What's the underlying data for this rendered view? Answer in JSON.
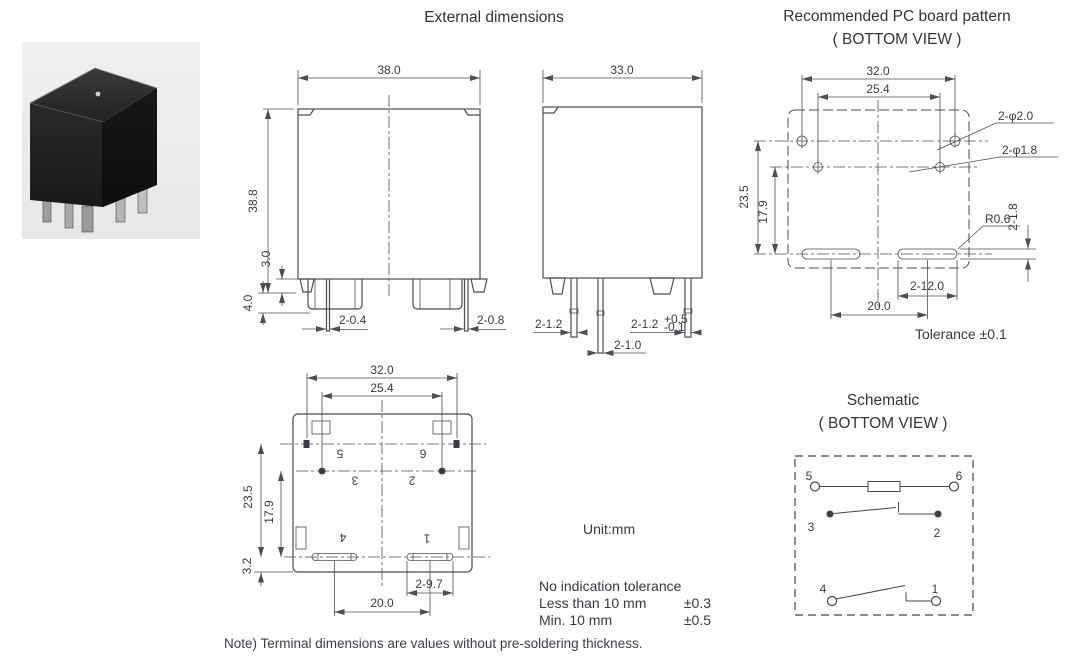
{
  "titles": {
    "external": "External dimensions",
    "pcb1": "Recommended PC board pattern",
    "pcb2": "( BOTTOM VIEW )",
    "sch1": "Schematic",
    "sch2": "( BOTTOM VIEW )"
  },
  "front_view": {
    "width": "38.0",
    "height": "38.8",
    "standoff": "3.0",
    "terminal": "4.0",
    "pin_thin": "2-0.4",
    "pin_wide": "2-0.8"
  },
  "side_view": {
    "width": "33.0",
    "pin_left": "2-1.2",
    "pin_right": "2-1.2",
    "pin_right_sup": "+0.5",
    "pin_right_sub": "-0.1",
    "pin_center": "2-1.0"
  },
  "bottom_view": {
    "w_outer": "32.0",
    "w_inner": "25.4",
    "h_outer": "23.5",
    "h_inner": "17.9",
    "offset": "3.2",
    "slot": "2-9.7",
    "pitch": "20.0",
    "pin5": "5",
    "pin6": "6",
    "pin3": "3",
    "pin2": "2",
    "pin4": "4",
    "pin1": "1"
  },
  "pcb_view": {
    "w_outer": "32.0",
    "w_inner": "25.4",
    "h_outer": "23.5",
    "h_inner": "17.9",
    "hole_large": "2-φ2.0",
    "hole_small": "2-φ1.8",
    "radius": "R0.6",
    "slot_width": "2-1.8",
    "slot_length": "2-12.0",
    "pitch": "20.0",
    "tolerance": "Tolerance ±0.1"
  },
  "schematic": {
    "pin5": "5",
    "pin6": "6",
    "pin3": "3",
    "pin2": "2",
    "pin4": "4",
    "pin1": "1"
  },
  "notes": {
    "unit": "Unit:mm",
    "tol_title": "No indication tolerance",
    "tol_r1_label": "Less than 10 mm",
    "tol_r1_value": "±0.3",
    "tol_r2_label": "Min. 10 mm",
    "tol_r2_value": "±0.5",
    "footnote": "Note) Terminal dimensions are values without pre-soldering thickness."
  }
}
